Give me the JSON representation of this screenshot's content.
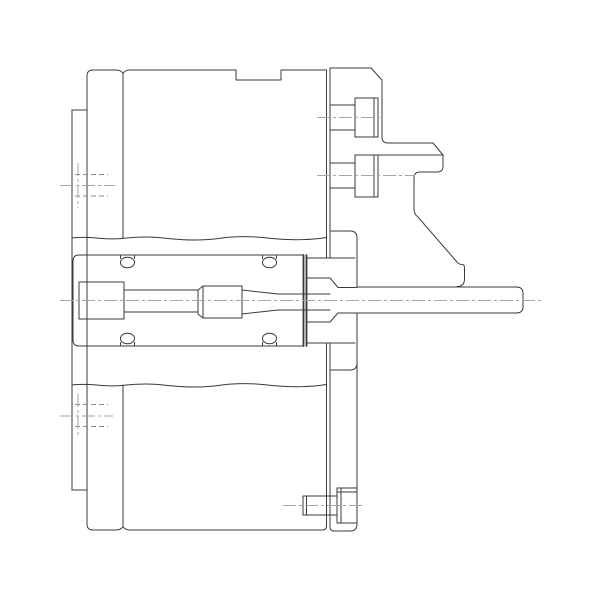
{
  "drawing": {
    "canvas": {
      "width": 600,
      "height": 600,
      "background": "#ffffff"
    },
    "style": {
      "line_color": "#3a3a3a",
      "centerline_color": "#a6a6a6",
      "hidden_color": "#8c8c8c",
      "line_width": 1,
      "thick_width": 1.8,
      "centerline_width": 1,
      "centerline_dash": "13 3 3 3",
      "hidden_dash": "5 3"
    },
    "parts": [
      {
        "name": "left-flange-plate",
        "paths": [
          "M72,110 H87",
          "M72,110 V490",
          "M72,490 H87"
        ]
      },
      {
        "name": "main-housing",
        "paths": [
          "M87,76 Q87,70 93,70 H116 Q121,70 123,73.5 Q125,70 130,70 H236 V80 H281 V70 H326.5",
          "M87,76 V524",
          "M87,524 Q87,530 93,530 H116 Q121,530 123,526.5 Q125,530 130,530 H322 Q326.5,530 326.5,526",
          "M123,73.5 V238",
          "M123,526.5 V385"
        ]
      },
      {
        "name": "break-lines",
        "paths": [
          "M72,238 C90,235.5 104,240.5 122,238.5 C140,236.5 152,236.5 168,238.5 C186,240.5 206,240.5 222,238 C240,235.5 256,236.5 272,238.5 C290,240.5 312,240 326,237.5",
          "M72,385 C90,382.5 104,387.5 122,385.5 C140,383.5 152,383.5 168,385.5 C186,387.5 206,387.5 222,385 C240,382.5 256,383.5 272,385.5 C290,387.5 312,387 326,384.5"
        ]
      },
      {
        "name": "adapter-plate-joint",
        "paths": [
          "M326.5,70 V258",
          "M326.5,343 V526",
          "M330,68 V258",
          "M330,343 V527"
        ]
      },
      {
        "name": "cylinder-block",
        "paths": [
          "M73,261 Q73,255 79,255 H303.5",
          "M73,261 V340",
          "M73,340 Q73,346 79,346 H303.5",
          "M306.5,258 H355",
          "M306.5,343 H355"
        ]
      },
      {
        "name": "piston-face",
        "width": 1.8,
        "paths": [
          "M303.5,255 V346",
          "M306.5,255 V346"
        ]
      },
      {
        "name": "piston-rod",
        "paths": [
          "M79,282 H124 V319 H79 Z",
          "M124,290 H198",
          "M124,312 H198",
          "M198,290 V314",
          "M198,290 L203,286",
          "M198,314 L203,318",
          "M203,286 V318",
          "M203,286 H242",
          "M203,318 H242",
          "M242,286 V318",
          "M242,290 L278,294",
          "M242,314 L278,310",
          "M278,294 H330",
          "M278,310 H330"
        ]
      },
      {
        "name": "collet-cone",
        "paths": [
          "M306.5,278 H330 L338,287.5 H357",
          "M306.5,322 H330 L338,313 H357"
        ]
      },
      {
        "name": "shaft-hub",
        "paths": [
          "M331,231 H350 Q357,231 357,238 V287",
          "M357,313 V488",
          "M331,370 H350 Q357,370 357,363"
        ]
      },
      {
        "name": "drive-shaft",
        "paths": [
          "M357,287 H516 Q523,287 523,293 V307 Q523,313 516,313 H357"
        ]
      },
      {
        "name": "stopper-bracket",
        "paths": [
          "M330,68 H371 L382,80 V137 Q382,143 388,143 H433 L443,155 V166 Q443,172 437,172 H420 Q414,172 414,178 V209 Q414,214 417.5,216.5 L457,262 Q459,264.5 462,264.5 Q464.5,264.5 464.5,267.5 V279 Q464.5,286.5 457,286.5",
          "M378,155 H443"
        ]
      },
      {
        "name": "cap-screw-upper",
        "paths": [
          "M355,98 H378 V137 H355 Z",
          "M374,98 V137",
          "M330,105 H355",
          "M330,130 H355"
        ]
      },
      {
        "name": "cap-screw-middle",
        "paths": [
          "M355,155 H378 V197 H355 Z",
          "M374,155 V197",
          "M330,163 H355",
          "M330,188 H355"
        ]
      },
      {
        "name": "cap-screw-lower",
        "paths": [
          "M337,488 H357 V523 H337 Z",
          "M341,488 V523",
          "M337,492 H357",
          "M303,496 H337",
          "M303,515 H337",
          "M303,496 V515",
          "M306.5,496 V515"
        ]
      },
      {
        "name": "base-plate-bottom",
        "paths": [
          "M330,527 Q330,531 334,531 H350 Q357,531 357,524"
        ]
      },
      {
        "name": "o-ring-groove-ticks",
        "paths": [
          "M120.5,255 V258.5",
          "M134.5,255 V258.5",
          "M262.5,255 V258.5",
          "M276.5,255 V258.5",
          "M120.5,342.5 V346",
          "M134.5,342.5 V346",
          "M262.5,342.5 V346",
          "M276.5,342.5 V346"
        ]
      }
    ],
    "o_rings": [
      {
        "name": "o-ring-top-left",
        "cx": 127.5,
        "cy": 262.5,
        "rx": 7,
        "ry": 5.3
      },
      {
        "name": "o-ring-top-right",
        "cx": 269.5,
        "cy": 262.5,
        "rx": 7,
        "ry": 5.3
      },
      {
        "name": "o-ring-bottom-left",
        "cx": 127.5,
        "cy": 338.5,
        "rx": 7,
        "ry": 5.3
      },
      {
        "name": "o-ring-bottom-right",
        "cx": 269.5,
        "cy": 338.5,
        "rx": 7,
        "ry": 5.3
      }
    ],
    "centerlines": [
      {
        "name": "main-axis",
        "d": "M60,300.5 H541"
      },
      {
        "name": "upper-bolt-axis",
        "d": "M317,117.5 H380"
      },
      {
        "name": "middle-bolt-axis",
        "d": "M317,175.5 H415"
      },
      {
        "name": "lower-bolt-axis",
        "d": "M283,505.5 H363"
      },
      {
        "name": "upper-port-axis-h",
        "d": "M60,185.5 H115"
      },
      {
        "name": "upper-port-axis-v",
        "d": "M78,163 V208"
      },
      {
        "name": "lower-port-axis-h",
        "d": "M60,416 H113"
      },
      {
        "name": "lower-port-axis-v",
        "d": "M78,394 V438"
      }
    ],
    "hidden_lines": [
      {
        "name": "upper-port-bore-top",
        "d": "M75,174.5 H108"
      },
      {
        "name": "upper-port-bore-bottom",
        "d": "M75,196 H108"
      },
      {
        "name": "lower-port-bore-top",
        "d": "M75,404.5 H108"
      },
      {
        "name": "lower-port-bore-bottom",
        "d": "M75,426.5 H108"
      }
    ]
  }
}
